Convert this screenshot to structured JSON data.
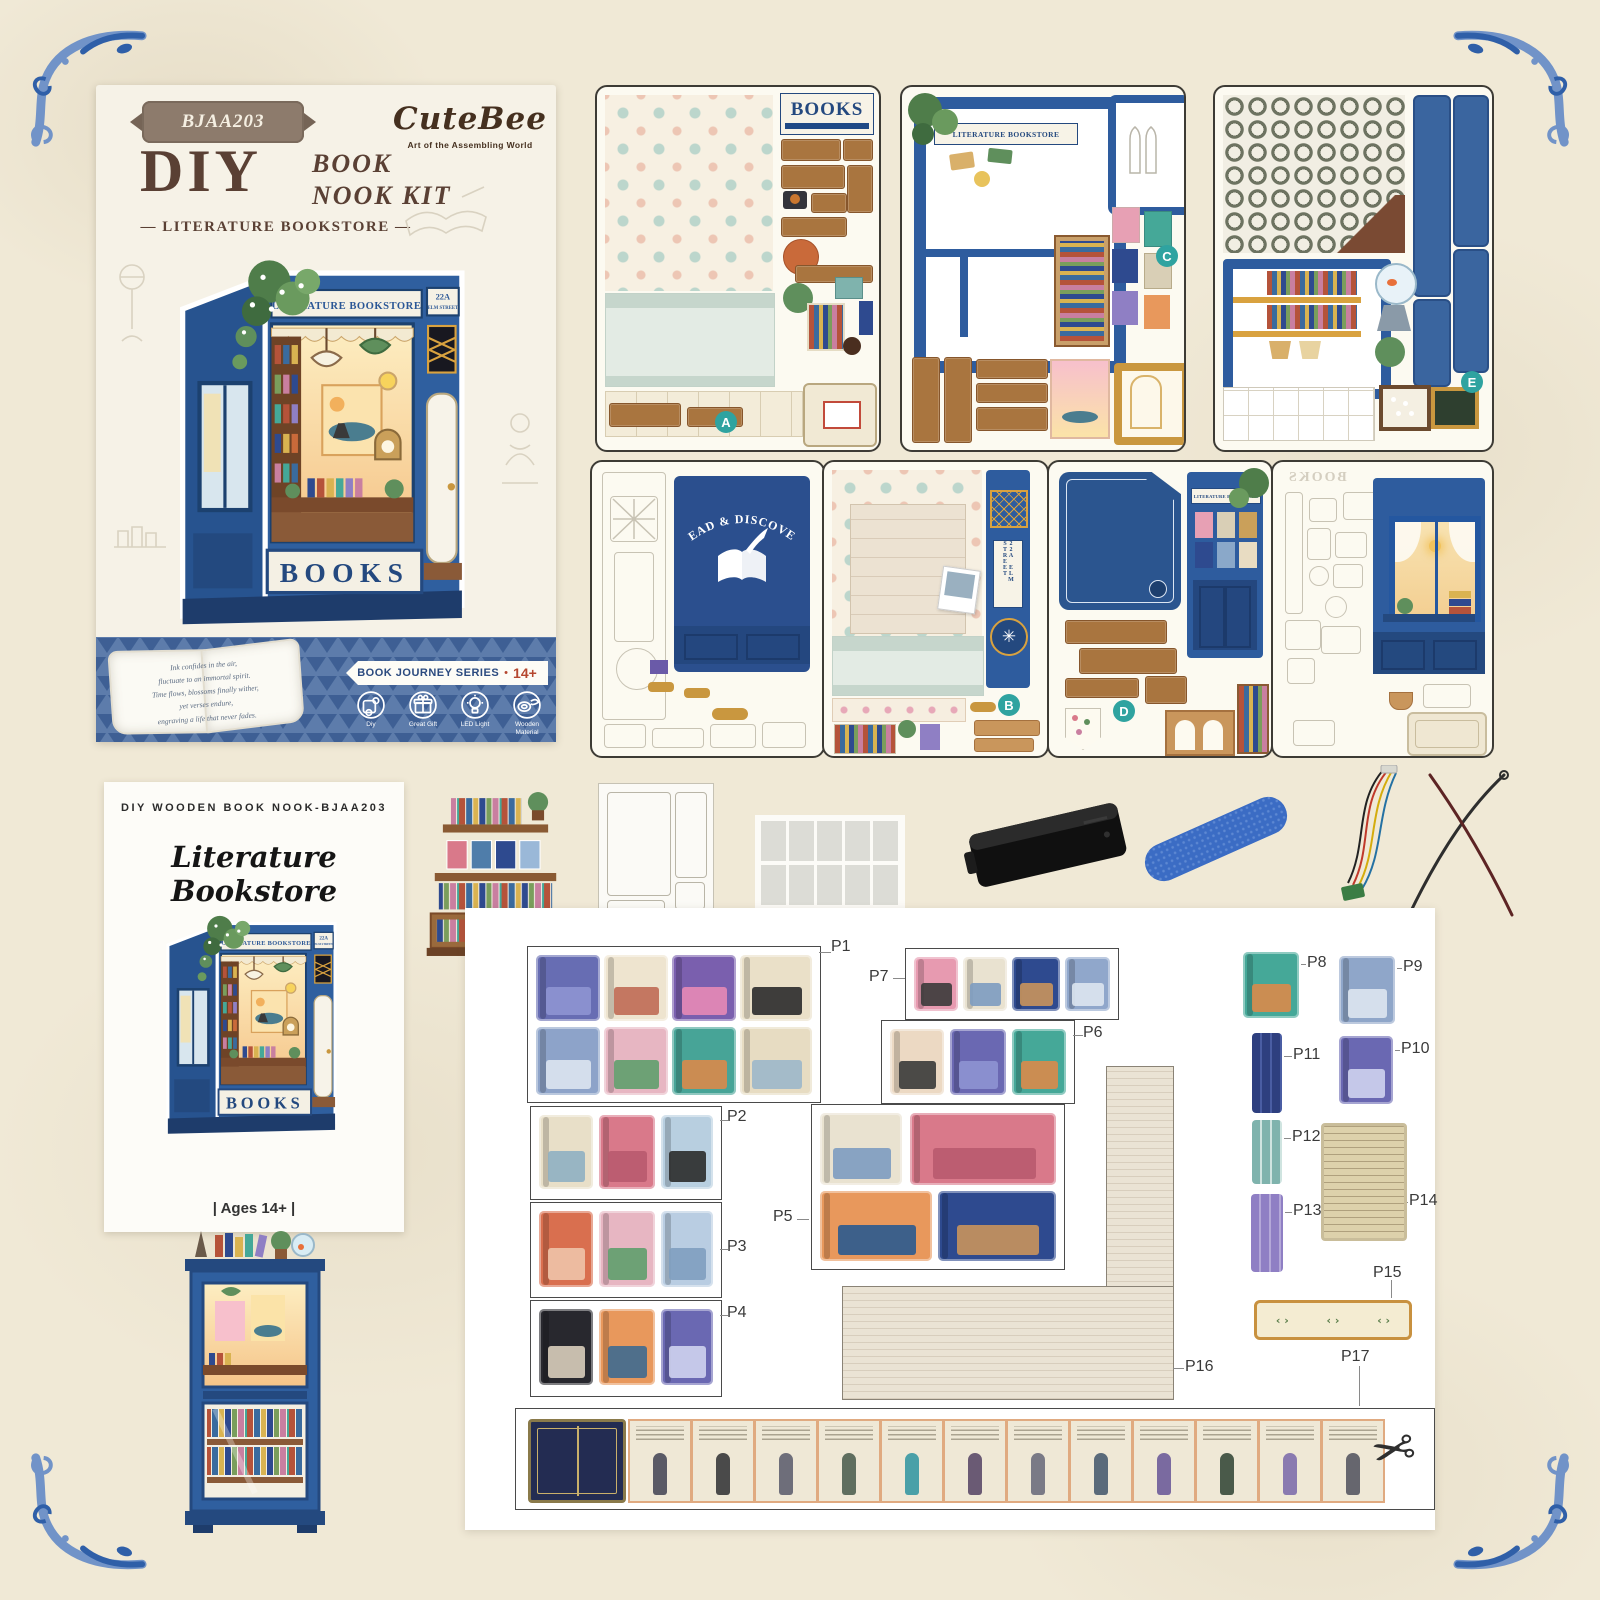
{
  "colors": {
    "bg": "#f0e9d6",
    "flourish": "#2f5fa8",
    "flourish_light": "#7193c8",
    "navy": "#24497f",
    "box_blue": "#2f5f9f",
    "band": "#5d7cab",
    "band_tri": "#3e5f94",
    "badge_teal": "#2fa3a0",
    "ribbon_red": "#b5472f",
    "wood": "#a9753f"
  },
  "box_art": {
    "model": "BJAA203",
    "title": "DIY",
    "title_sub1": "BOOK",
    "title_sub2": "NOOK KIT",
    "subtitle": "LITERATURE BOOKSTORE",
    "brand": "CuteBee",
    "tagline": "Art of the Assembling World",
    "sign": "LITERATURE BOOKSTORE",
    "address": "22A",
    "address2": "ELM STREET",
    "books": "BOOKS",
    "poem": [
      "Ink confides in the air,",
      "fluctuate to an immortal spirit.",
      "Time flows, blossoms finally wither,",
      "yet verses endure,",
      "engraving a life that never fades."
    ],
    "ribbon": "BOOK JOURNEY SERIES",
    "age": "14+",
    "features": [
      "Diy",
      "Great Gift",
      "LED Light",
      "Wooden Material"
    ]
  },
  "sheets": {
    "a": {
      "badge": "A",
      "sign": "BOOKS"
    },
    "c": {
      "badge": "C",
      "sign": "LITERATURE BOOKSTORE"
    },
    "e": {
      "badge": "E"
    },
    "rd": {
      "title": "READ & DISCOVER"
    },
    "b": {
      "badge": "B",
      "address": "22A ELM STREET"
    },
    "d": {
      "badge": "D",
      "sign": "LITERATURE BOOKSTORE"
    },
    "w": {
      "mirror_sign": "BOOKS"
    }
  },
  "manual": {
    "header": "DIY WOODEN BOOK NOOK-BJAA203",
    "title": "Literature Bookstore",
    "age": "| Ages 14+ |"
  },
  "parts_panel": {
    "groups": [
      {
        "label": "P1",
        "box": [
          62,
          38,
          292,
          155
        ],
        "label_pos": [
          366,
          30
        ],
        "leader": [
          354,
          44,
          12,
          "h"
        ],
        "covers": [
          [
            8,
            8,
            64,
            66,
            "#676db3",
            "#8e93d2"
          ],
          [
            76,
            8,
            64,
            66,
            "#eee4cf",
            "#bf6a54"
          ],
          [
            144,
            8,
            64,
            66,
            "#7a5fae",
            "#e78ab6"
          ],
          [
            212,
            8,
            72,
            66,
            "#eae0c8",
            "#2b2b2b"
          ],
          [
            8,
            80,
            64,
            68,
            "#8da3c9",
            "#dbe4f0"
          ],
          [
            76,
            80,
            64,
            68,
            "#e7b6c2",
            "#5f9e6d"
          ],
          [
            144,
            80,
            64,
            68,
            "#47a497",
            "#d98a4a"
          ],
          [
            212,
            80,
            72,
            68,
            "#e7dcc2",
            "#9cb7ca"
          ]
        ]
      },
      {
        "label": "P7",
        "box": [
          440,
          40,
          212,
          70
        ],
        "label_pos": [
          404,
          60
        ],
        "leader": [
          428,
          70,
          12,
          "h"
        ],
        "covers": [
          [
            8,
            8,
            44,
            54,
            "#e79ab0",
            "#3b3b3b"
          ],
          [
            57,
            8,
            44,
            54,
            "#e9e2d0",
            "#7d9cc0"
          ],
          [
            106,
            8,
            48,
            54,
            "#2e4a8f",
            "#c9935c"
          ],
          [
            159,
            8,
            45,
            54,
            "#90a7cb",
            "#dde6f0"
          ]
        ]
      },
      {
        "label": "P6",
        "box": [
          416,
          112,
          192,
          82
        ],
        "label_pos": [
          618,
          116
        ],
        "leader": [
          608,
          127,
          10,
          "h"
        ],
        "covers": [
          [
            8,
            8,
            54,
            66,
            "#ecd9c3",
            "#3a3a3a"
          ],
          [
            68,
            8,
            56,
            66,
            "#6a68b2",
            "#8e93d2"
          ],
          [
            130,
            8,
            54,
            66,
            "#45a898",
            "#d98a4a"
          ]
        ]
      },
      {
        "label": "P2",
        "box": [
          65,
          198,
          190,
          92
        ],
        "label_pos": [
          262,
          200
        ],
        "leader": [
          255,
          212,
          8,
          "h"
        ],
        "covers": [
          [
            8,
            8,
            54,
            74,
            "#e8dfc8",
            "#8fb0c2"
          ],
          [
            68,
            8,
            56,
            74,
            "#d9798a",
            "#b85a6e"
          ],
          [
            130,
            8,
            52,
            74,
            "#b8cfe0",
            "#2b2b2b"
          ]
        ]
      },
      {
        "label": "P3",
        "box": [
          65,
          294,
          190,
          94
        ],
        "label_pos": [
          262,
          330
        ],
        "leader": [
          255,
          341,
          8,
          "h"
        ],
        "covers": [
          [
            8,
            8,
            54,
            76,
            "#d96f4f",
            "#eec3a8"
          ],
          [
            68,
            8,
            56,
            76,
            "#e7b6c2",
            "#5f9e6d"
          ],
          [
            130,
            8,
            52,
            76,
            "#b9cde2",
            "#7f9fc0"
          ]
        ]
      },
      {
        "label": "P4",
        "box": [
          65,
          392,
          190,
          95
        ],
        "label_pos": [
          262,
          396
        ],
        "leader": [
          255,
          407,
          8,
          "h"
        ],
        "covers": [
          [
            8,
            8,
            54,
            76,
            "#28282e",
            "#d8cdbb"
          ],
          [
            68,
            8,
            56,
            76,
            "#e8985c",
            "#3e6a90"
          ],
          [
            130,
            8,
            52,
            76,
            "#6a68b2",
            "#cfd3ee"
          ]
        ]
      },
      {
        "label": "P5",
        "box": [
          346,
          196,
          252,
          164
        ],
        "label_pos": [
          308,
          300
        ],
        "leader": [
          332,
          311,
          12,
          "h"
        ],
        "covers": [
          [
            8,
            8,
            82,
            72,
            "#e9e2d0",
            "#7d9cc0"
          ],
          [
            98,
            8,
            146,
            72,
            "#d9798a",
            "#b85a6e"
          ],
          [
            8,
            86,
            112,
            70,
            "#e8985c",
            "#2a5a8f"
          ],
          [
            126,
            86,
            118,
            70,
            "#2e4a8f",
            "#c9935c"
          ]
        ]
      }
    ],
    "singles": [
      {
        "label": "P8",
        "type": "cover",
        "item": [
          778,
          44,
          56,
          66
        ],
        "bg": "#45a898",
        "accent": "#d98a4a",
        "label_pos": [
          842,
          46
        ],
        "leader": [
          836,
          56,
          5,
          "h"
        ]
      },
      {
        "label": "P9",
        "type": "cover",
        "item": [
          874,
          48,
          56,
          68
        ],
        "bg": "#8fa6c9",
        "accent": "#dde6f0",
        "label_pos": [
          938,
          50
        ],
        "leader": [
          932,
          60,
          5,
          "h"
        ]
      },
      {
        "label": "P11",
        "type": "spines",
        "item": [
          787,
          125,
          30,
          80
        ],
        "bg": "#2e3f7f",
        "accent": "#4a5da3",
        "label_pos": [
          828,
          138
        ],
        "leader": [
          819,
          148,
          8,
          "h"
        ]
      },
      {
        "label": "P10",
        "type": "cover",
        "item": [
          874,
          128,
          54,
          68
        ],
        "bg": "#6a68b2",
        "accent": "#cfd3ee",
        "label_pos": [
          936,
          132
        ],
        "leader": [
          930,
          142,
          5,
          "h"
        ]
      },
      {
        "label": "P12",
        "type": "spines",
        "item": [
          787,
          212,
          30,
          64
        ],
        "bg": "#7fb3ad",
        "accent": "#cfe4e0",
        "label_pos": [
          827,
          220
        ],
        "leader": [
          819,
          230,
          7,
          "h"
        ]
      },
      {
        "label": "P13",
        "type": "spines",
        "item": [
          786,
          286,
          32,
          78
        ],
        "bg": "#8f7fc4",
        "accent": "#b4a8d8",
        "label_pos": [
          828,
          294
        ],
        "leader": [
          820,
          304,
          7,
          "h"
        ]
      },
      {
        "label": "P14",
        "type": "manuscript",
        "item": [
          856,
          215,
          80,
          112
        ],
        "bg": "#ddd1ab",
        "accent": "#8a744e",
        "label_pos": [
          944,
          284
        ],
        "leader": [
          938,
          294,
          5,
          "h"
        ]
      },
      {
        "label": "P15",
        "type": "strip",
        "item": [
          789,
          392,
          152,
          34
        ],
        "bg": "#f4ecd2",
        "accent": "#c8913f",
        "label_pos": [
          908,
          356
        ],
        "leader": [
          926,
          372,
          18,
          "v"
        ]
      },
      {
        "label": "P16",
        "type": "none",
        "label_pos": [
          720,
          450
        ],
        "leader": [
          708,
          460,
          11,
          "h"
        ]
      },
      {
        "label": "P17",
        "type": "none",
        "label_pos": [
          876,
          440
        ],
        "leader": [
          894,
          458,
          40,
          "v"
        ]
      }
    ],
    "strip": {
      "box": [
        50,
        500,
        918,
        100
      ],
      "cover": [
        12,
        10,
        92,
        78
      ],
      "page_start": 112,
      "page_w": 60,
      "page_h": 80,
      "page_gap": 3,
      "page_count": 12,
      "fig_colors": [
        "#5a5a66",
        "#4a4a4a",
        "#6e6e7a",
        "#5f6e5f",
        "#4aa0a8",
        "#6a5a74",
        "#7a7a86",
        "#5a6a7a",
        "#7a6aa0",
        "#4a5a4a",
        "#8a7ab0",
        "#66666e"
      ]
    }
  }
}
